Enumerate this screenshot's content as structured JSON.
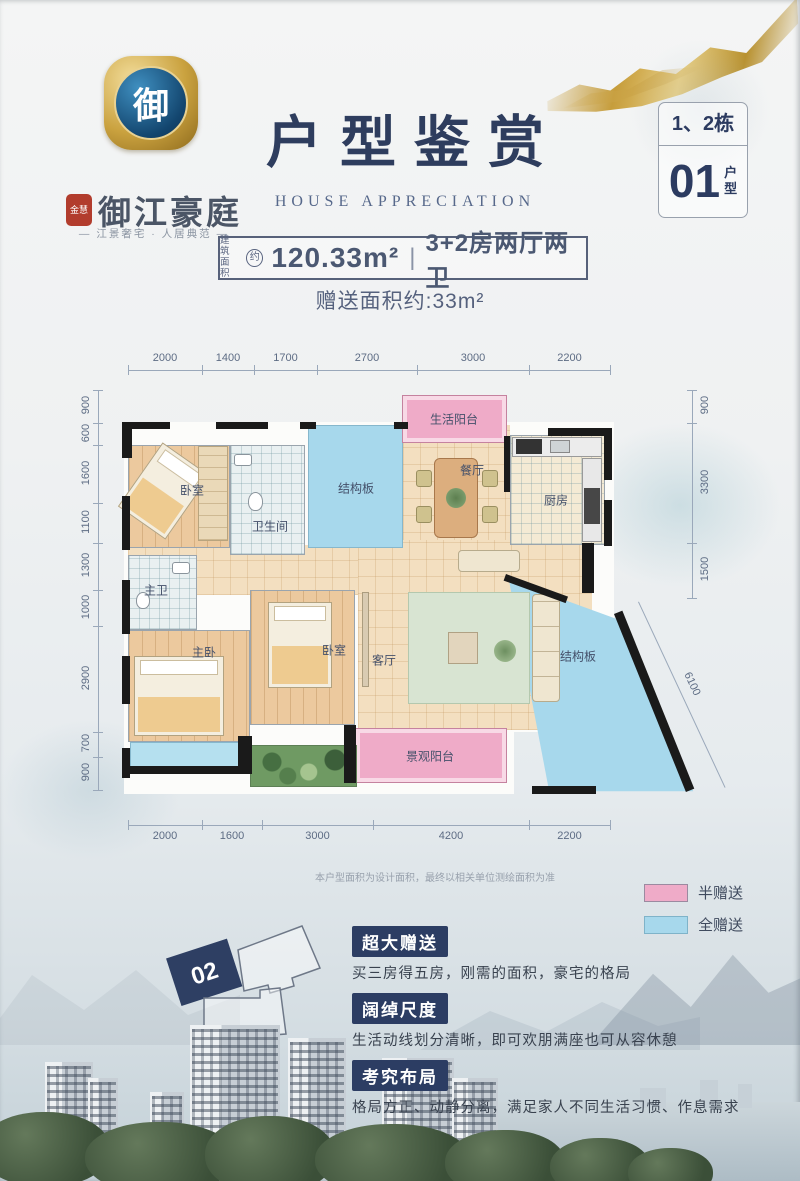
{
  "brand": {
    "emblem_char": "御",
    "seal": "金慧",
    "name": "御江豪庭",
    "tagline": "— 江景奢宅 · 人居典范 —"
  },
  "header": {
    "title": "户型鉴赏",
    "subtitle": "HOUSE APPRECIATION",
    "building": "1、2栋",
    "unit_no": "01",
    "unit_word_1": "户",
    "unit_word_2": "型"
  },
  "summary": {
    "area_label_1": "建筑",
    "area_label_2": "面积",
    "approx": "约",
    "area_value": "120.33m²",
    "divider": "|",
    "layout": "3+2房两厅两卫",
    "gift": "赠送面积约:33m²"
  },
  "floorplan": {
    "dims_top": [
      "2000",
      "1400",
      "1700",
      "2700",
      "3000",
      "2200"
    ],
    "dims_bottom": [
      "2000",
      "1600",
      "3000",
      "4200",
      "2200"
    ],
    "dims_left": [
      "900",
      "600",
      "1600",
      "1100",
      "1300",
      "1000",
      "2900",
      "700",
      "900"
    ],
    "dims_right": [
      "900",
      "3300",
      "1500"
    ],
    "dim_diagonal": "6100",
    "rooms": {
      "bedroom1": "卧室",
      "bathroom": "卫生间",
      "slab1": "结构板",
      "life_balcony": "生活阳台",
      "dining": "餐厅",
      "kitchen": "厨房",
      "master_bath": "主卫",
      "master_bedroom": "主卧",
      "bedroom2": "卧室",
      "living": "客厅",
      "view_balcony": "景观阳台",
      "slab2": "结构板"
    }
  },
  "legend": {
    "half_label": "半赠送",
    "half_color": "#efabc8",
    "full_label": "全赠送",
    "full_color": "#a7d8ec"
  },
  "note": "本户型面积为设计面积，最终以相关单位测绘面积为准",
  "siteplan": {
    "highlight": "02"
  },
  "features": [
    {
      "title": "超大赠送",
      "desc": "买三房得五房，刚需的面积，豪宅的格局"
    },
    {
      "title": "阔绰尺度",
      "desc": "生活动线划分清晰，即可欢朋满座也可从容休憩"
    },
    {
      "title": "考究布局",
      "desc": "格局方正、动静分离，满足家人不同生活习惯、作息需求"
    }
  ],
  "colors": {
    "navy": "#2c3d63",
    "gold": "#c9a144",
    "text_blue": "#4b5872"
  }
}
